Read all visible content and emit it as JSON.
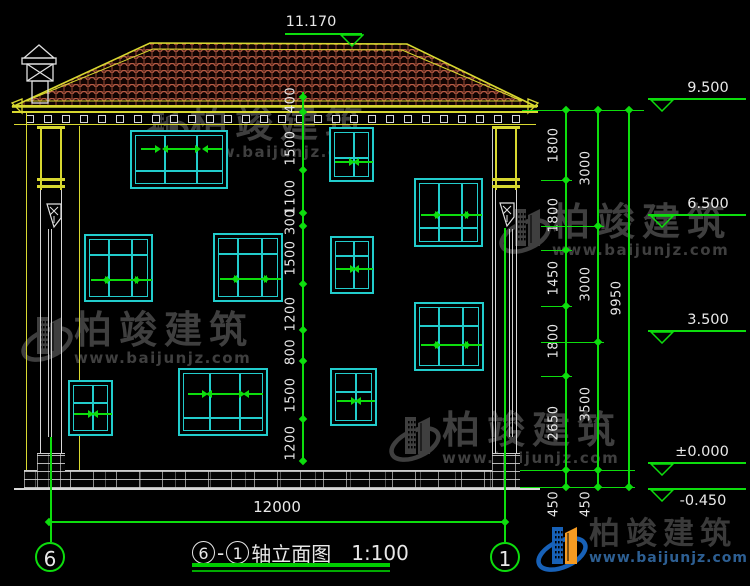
{
  "title_block": {
    "axis_start": "6",
    "separator": "-",
    "axis_end": "1",
    "name": "轴立面图",
    "scale": "1:100"
  },
  "axis_bubbles": [
    {
      "label": "6",
      "x": 50,
      "y": 557
    },
    {
      "label": "1",
      "x": 505,
      "y": 557
    }
  ],
  "dimensions": {
    "bottom_width": {
      "text": "12000",
      "x1": 49,
      "x2": 505,
      "y": 521,
      "label_x": 277,
      "label_y": 508
    },
    "top_elevation": {
      "text": "11.170",
      "line_x1": 285,
      "line_x2": 362,
      "y": 33,
      "tri_x": 340,
      "label_x": 311,
      "label_y": 14
    },
    "elevation_marks": [
      {
        "text": "9.500",
        "y": 98,
        "label_x": 708,
        "label_dy": -18,
        "below": false
      },
      {
        "text": "6.500",
        "y": 214,
        "label_x": 708,
        "label_dy": -18,
        "below": false
      },
      {
        "text": "3.500",
        "y": 330,
        "label_x": 708,
        "label_dy": -18,
        "below": false
      },
      {
        "text": "±0.000",
        "y": 462,
        "label_x": 702,
        "label_dy": -18,
        "below": false
      },
      {
        "text": "-0.450",
        "y": 488,
        "label_x": 703,
        "label_dy": 5,
        "below": true
      }
    ],
    "left_chain": {
      "x": 302,
      "y1": 92,
      "y2": 461,
      "ticks": [
        97,
        112,
        170,
        213,
        226,
        284,
        330,
        361,
        419,
        461
      ],
      "labels": [
        {
          "text": "400",
          "y": 100
        },
        {
          "text": "1500",
          "y": 148
        },
        {
          "text": "1100",
          "y": 197
        },
        {
          "text": "300",
          "y": 222
        },
        {
          "text": "1500",
          "y": 258
        },
        {
          "text": "1200",
          "y": 314
        },
        {
          "text": "800",
          "y": 352
        },
        {
          "text": "1500",
          "y": 395
        },
        {
          "text": "1200",
          "y": 443
        }
      ]
    },
    "right_chains": [
      {
        "x": 565,
        "y1": 110,
        "y2": 487,
        "ticks": [
          110,
          180,
          250,
          306,
          376,
          470,
          487
        ],
        "labels": [
          {
            "text": "1800",
            "y": 145
          },
          {
            "text": "1800",
            "y": 215
          },
          {
            "text": "1450",
            "y": 278
          },
          {
            "text": "1800",
            "y": 341
          },
          {
            "text": "2650",
            "y": 423
          },
          {
            "text": "450",
            "y": 504
          }
        ]
      },
      {
        "x": 597,
        "y1": 110,
        "y2": 487,
        "ticks": [
          110,
          226,
          342,
          470,
          487
        ],
        "labels": [
          {
            "text": "3000",
            "y": 168
          },
          {
            "text": "3000",
            "y": 284
          },
          {
            "text": "3500",
            "y": 404
          },
          {
            "text": "450",
            "y": 504
          }
        ]
      },
      {
        "x": 628,
        "y1": 110,
        "y2": 487,
        "ticks": [
          110,
          487
        ],
        "labels": [
          {
            "text": "9950",
            "y": 298
          }
        ]
      }
    ],
    "connectors": [
      {
        "y": 110,
        "x1": 522,
        "x2": 644
      },
      {
        "y": 180,
        "x1": 541,
        "x2": 572
      },
      {
        "y": 226,
        "x1": 541,
        "x2": 604
      },
      {
        "y": 250,
        "x1": 541,
        "x2": 572
      },
      {
        "y": 306,
        "x1": 541,
        "x2": 572
      },
      {
        "y": 342,
        "x1": 541,
        "x2": 604
      },
      {
        "y": 376,
        "x1": 541,
        "x2": 572
      },
      {
        "y": 470,
        "x1": 520,
        "x2": 635
      },
      {
        "y": 487,
        "x1": 520,
        "x2": 635
      }
    ]
  },
  "facade": {
    "windows": [
      {
        "x": 130,
        "y": 130,
        "w": 98,
        "h": 59,
        "cols": 3,
        "divider": 0.64,
        "arrow_row": 0.28,
        "arrows": [
          "r",
          "lr",
          "l"
        ]
      },
      {
        "x": 329,
        "y": 127,
        "w": 45,
        "h": 55,
        "cols": 2,
        "divider": 0.5,
        "arrow_row": 0.6,
        "arrows": [
          "r",
          "l"
        ]
      },
      {
        "x": 414,
        "y": 178,
        "w": 69,
        "h": 69,
        "cols": 3,
        "divider": 0.68,
        "arrow_row": 0.5,
        "arrows": [
          "r",
          "lr",
          "l"
        ]
      },
      {
        "x": 84,
        "y": 234,
        "w": 69,
        "h": 68,
        "cols": 3,
        "divider": 0.26,
        "arrow_row": 0.64,
        "arrows": [
          "r",
          "lr",
          "l"
        ]
      },
      {
        "x": 213,
        "y": 233,
        "w": 70,
        "h": 69,
        "cols": 3,
        "divider": 0.26,
        "arrow_row": 0.64,
        "arrows": [
          "r",
          "lr",
          "l"
        ]
      },
      {
        "x": 330,
        "y": 236,
        "w": 44,
        "h": 58,
        "cols": 2,
        "divider": 0.3,
        "arrow_row": 0.54,
        "arrows": [
          "r",
          "l"
        ]
      },
      {
        "x": 414,
        "y": 302,
        "w": 70,
        "h": 69,
        "cols": 3,
        "divider": 0.3,
        "arrow_row": 0.6,
        "arrows": [
          "r",
          "lr",
          "l"
        ]
      },
      {
        "x": 330,
        "y": 368,
        "w": 47,
        "h": 58,
        "cols": 2,
        "divider": 0.36,
        "arrow_row": 0.54,
        "arrows": [
          "r",
          "l"
        ]
      },
      {
        "x": 68,
        "y": 380,
        "w": 45,
        "h": 56,
        "cols": 2,
        "divider": 0.36,
        "arrow_row": 0.58,
        "arrows": [
          "r",
          "l"
        ]
      },
      {
        "x": 178,
        "y": 368,
        "w": 90,
        "h": 68,
        "cols": 3,
        "divider": 0.69,
        "arrow_row": 0.35,
        "arrows": [
          "r",
          "lr",
          "l"
        ]
      }
    ]
  },
  "watermark": {
    "brand": "柏竣建筑",
    "url": "www.baijunjz.com",
    "positions": [
      {
        "x": 136,
        "y": 102
      },
      {
        "x": 20,
        "y": 308
      },
      {
        "x": 498,
        "y": 200
      },
      {
        "x": 388,
        "y": 408
      }
    ]
  },
  "footer_logo": {
    "brand": "柏竣建筑",
    "url": "www.baijunjz.com"
  },
  "colors": {
    "green": "#0ddd0d",
    "cyan": "#22cccc",
    "yellow": "#d8d830",
    "white": "#e8e8e8",
    "tile_red": "#a8523a",
    "tile_red_light": "#c2604a",
    "watermark_gray": "#3f3f3f",
    "logo_blue": "#1761b8",
    "logo_orange": "#f59b22"
  }
}
